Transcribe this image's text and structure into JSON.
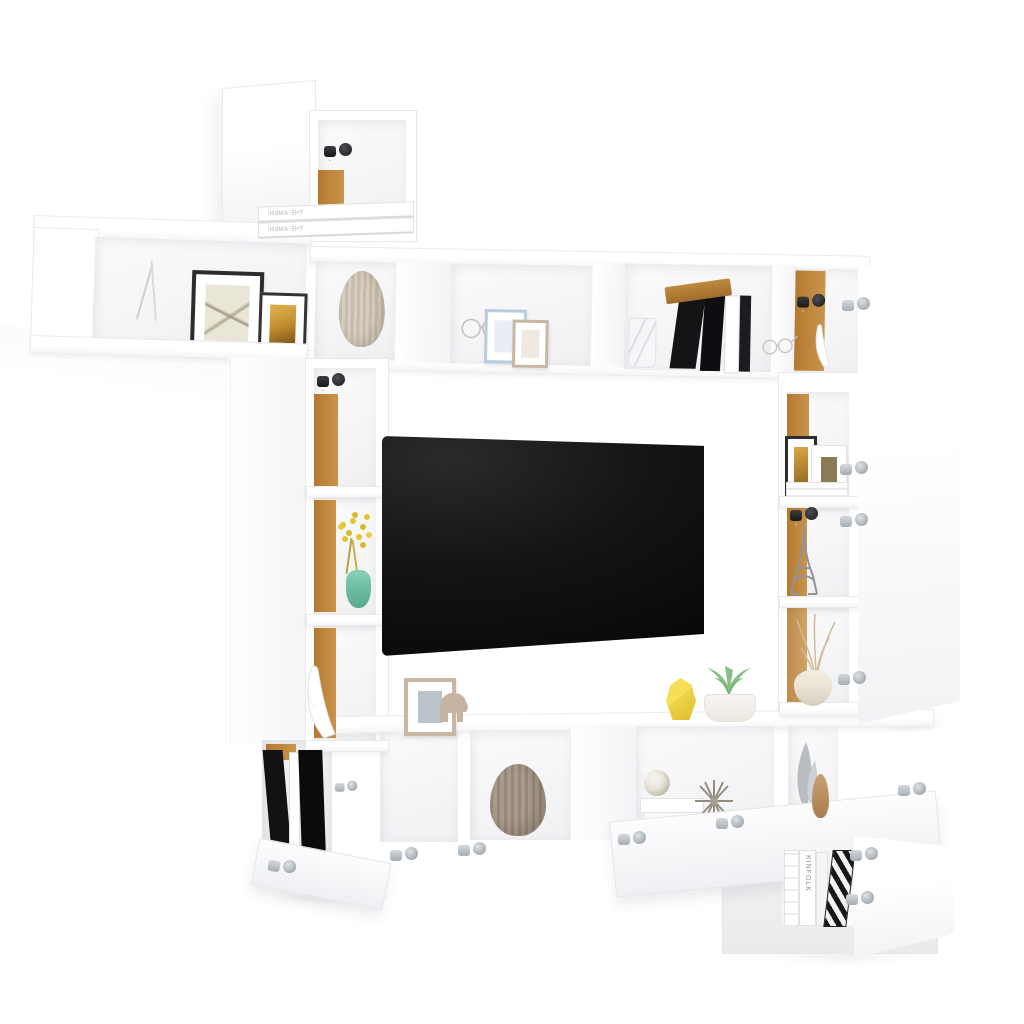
{
  "scene": {
    "type": "product-photo",
    "subject": "White wall-mounted TV entertainment wall unit set with open doors and decor, on plain white background",
    "background_color": "#ffffff",
    "finish": "high-gloss white",
    "interior_accent": "oak brown back panels"
  },
  "texts": {
    "book_spine_top": "THE AMERI",
    "kinfolk_spine": "KINFOLK"
  },
  "colors": {
    "edge_gray": "#e9e9eb",
    "wood_back": "#b5792f",
    "wood_light": "#c9944c",
    "tv_dark": "#141414",
    "tv_dark2": "#2a2a2a",
    "hinge_silver": "#a6adb3",
    "hinge_dark": "#17181a",
    "teal_vase": "#72c1a7",
    "flower_yellow": "#e4c431",
    "vase_yellow": "#eed34a",
    "succulent_green": "#88c084",
    "ribbed_beige": "#d7cec0",
    "ribbed_beige_dark": "#c7bcab",
    "taupe_vase": "#a89a8c",
    "taupe_vase_dark": "#978878",
    "frame_black": "#2c2c2c",
    "frame_amber": "#bf8c2f",
    "frame_blue": "#b7cdde",
    "frame_beige": "#c9b7a5",
    "elephant_beige": "#c6b3a2",
    "book_black": "#141417",
    "book_wood": "#c08a3e",
    "metal_wire": "#c2c2c4",
    "grass_tan": "#cfbc96",
    "leaf_gray": "#b9bdc2",
    "star_gray": "#948c80",
    "cream_vase": "#eae3d5"
  },
  "furniture_pieces": [
    {
      "name": "top-wall-cabinet",
      "state": "door open left, black hinge, oak interior"
    },
    {
      "name": "upper-left-shelf",
      "state": "open, two framed prints"
    },
    {
      "name": "upper-bridge-shelf",
      "state": "open compartments with vase, frames, books"
    },
    {
      "name": "left-column-shelf",
      "state": "three oak-backed niches"
    },
    {
      "name": "right-column-shelf",
      "state": "three oak-backed niches"
    },
    {
      "name": "right-tall-cabinet",
      "state": "tall door open right, four silver hinges"
    },
    {
      "name": "bottom-row-cabinets",
      "state": "flap doors open downward"
    },
    {
      "name": "corner-cabinet",
      "state": "door open right, books inside"
    }
  ],
  "decor_items": [
    "black framed botanical print",
    "small gold art frame",
    "ribbed beige vase",
    "wire eyeglasses ornament",
    "pastel blue frame",
    "beige frame",
    "marble canister",
    "leaning black books with oak book",
    "white antler ornament",
    "white book stack",
    "Eiffel tower figurine",
    "dried grass in cream vase",
    "yellow flowers in teal bottle",
    "beige photo frame",
    "elephant figurine",
    "faceted yellow vase",
    "succulent in white pot",
    "standing black books",
    "taupe ribbed vase",
    "white books with textured sphere",
    "sputnik starburst ornament",
    "gray leaf sculptures",
    "wooden teardrop vase",
    "KINFOLK magazine spines",
    "black-white chevron book"
  ],
  "electronics": {
    "tv": "wall-mounted flat screen, powered off, black"
  }
}
